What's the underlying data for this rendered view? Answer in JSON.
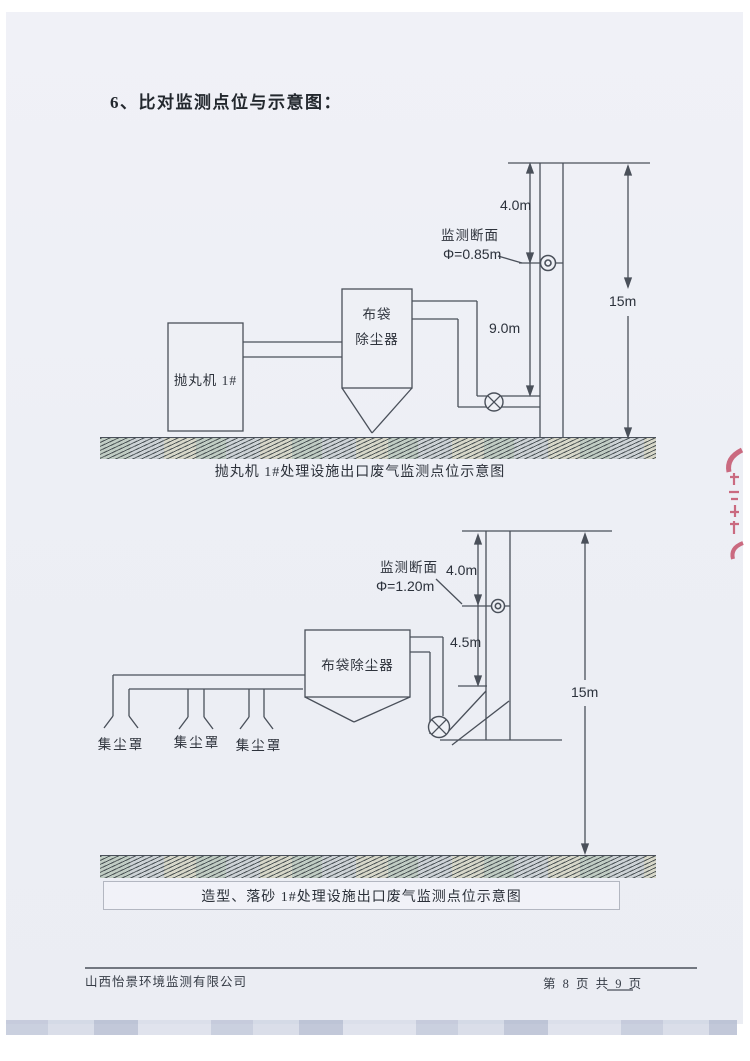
{
  "page": {
    "title": "6、比对监测点位与示意图：",
    "footer": {
      "company": "山西怡景环境监测有限公司",
      "page_info": "第 8 页 共 9 页"
    }
  },
  "diagram1": {
    "caption": "抛丸机 1#处理设施出口废气监测点位示意图",
    "machine": "抛丸机 1#",
    "collector_line1": "布袋",
    "collector_line2": "除尘器",
    "monitor_section": "监测断面",
    "diameter": "Φ=0.85m",
    "dim_top_to_section": "4.0m",
    "dim_section_to_inlet": "9.0m",
    "stack_height": "15m"
  },
  "diagram2": {
    "caption": "造型、落砂 1#处理设施出口废气监测点位示意图",
    "collector": "布袋除尘器",
    "hoods": [
      "集尘罩",
      "集尘罩",
      "集尘罩"
    ],
    "monitor_section": "监测断面",
    "diameter": "Φ=1.20m",
    "dim_top_to_section": "4.0m",
    "dim_section_to_inlet": "4.5m",
    "stack_height": "15m"
  },
  "colors": {
    "line": "#4a505a",
    "text": "#2e333c",
    "paper": "#eef0f5",
    "stamp": "#c24a63"
  }
}
